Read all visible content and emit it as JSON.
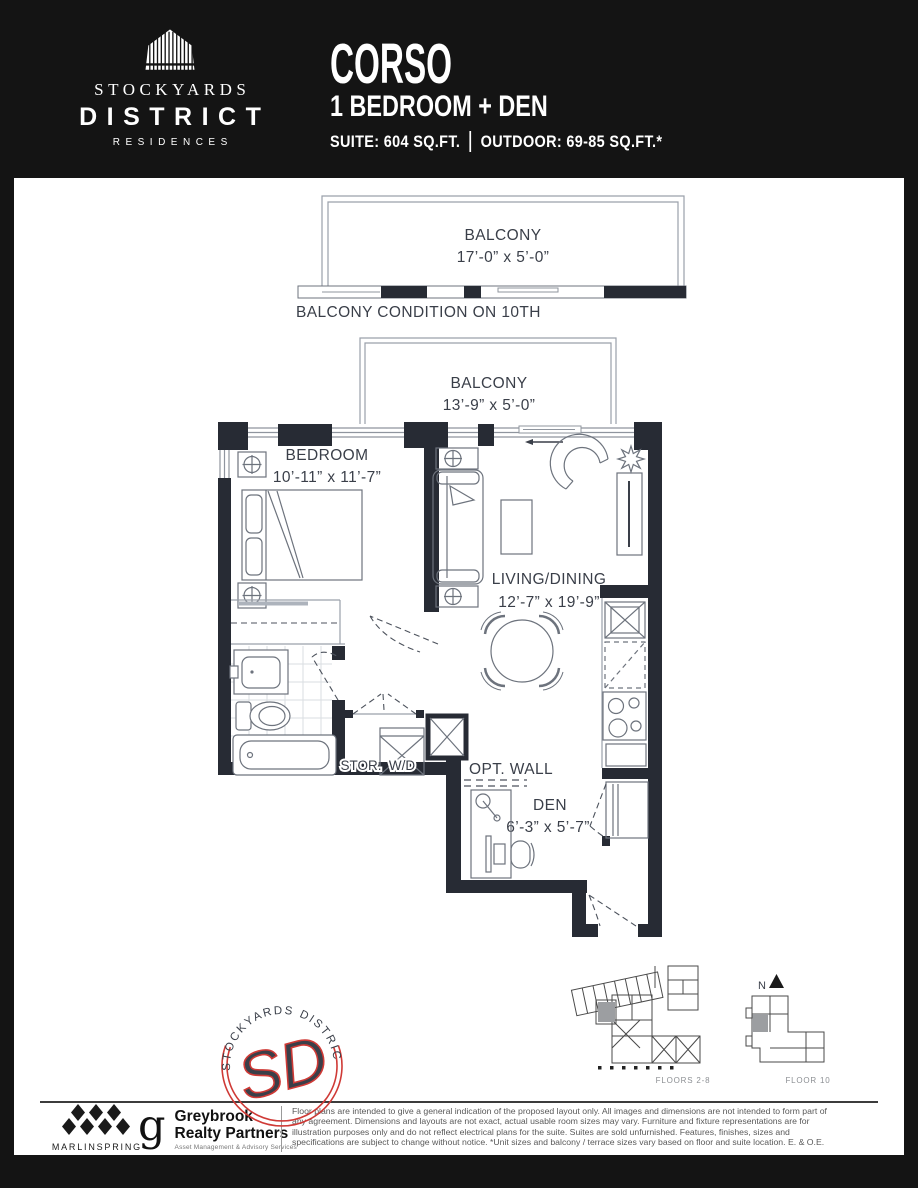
{
  "header": {
    "logo_line1": "STOCKYARDS",
    "logo_line2": "DISTRICT",
    "logo_line3": "RESIDENCES",
    "plan_name": "CORSO",
    "plan_type": "1 BEDROOM + DEN",
    "suite_area": "SUITE: 604 SQ.FT.",
    "outdoor_area": "OUTDOOR: 69-85 SQ.FT.*"
  },
  "floorplan": {
    "balcony_10th": {
      "label": "BALCONY",
      "dims": "17’-0” x 5’-0”",
      "note": "BALCONY CONDITION ON 10TH"
    },
    "balcony": {
      "label": "BALCONY",
      "dims": "13’-9” x 5’-0”"
    },
    "bedroom": {
      "label": "BEDROOM",
      "dims": "10’-11” x 11’-7”"
    },
    "living": {
      "label": "LIVING/DINING",
      "dims": "12’-7” x 19’-9”"
    },
    "den": {
      "label": "DEN",
      "dims": "6’-3” x 5’-7”"
    },
    "storage": "STOR.",
    "washer_dryer": "W/D",
    "optional_wall": "OPT. WALL"
  },
  "keyplan": {
    "north_label": "N",
    "floors_2_8_label": "FLOORS 2-8",
    "floor_10_label": "FLOOR 10"
  },
  "stamp": {
    "arc_text": "STOCKYARDS DISTRICT",
    "monogram": "SD"
  },
  "footer": {
    "marlinspring_label": "MARLINSPRING",
    "greybrook_glyph": "g",
    "greybrook_line1": "Greybrook",
    "greybrook_line2": "Realty Partners",
    "greybrook_tagline": "Asset Management & Advisory Services",
    "disclaimer": "Floor plans are intended to give a general indication of the proposed layout only. All images and dimensions are not intended to form part of any agreement. Dimensions and layouts are not exact, actual usable room sizes may vary. Furniture and fixture representations are for illustration purposes only and do not reflect electrical plans for the suite. Suites are sold unfurnished. Features, finishes, sizes and specifications are subject to change without notice. *Unit sizes and balcony / terrace sizes vary based on floor and suite location. E. & O.E."
  },
  "colors": {
    "wall": "#272b34",
    "accent_red": "#cf3a36"
  }
}
